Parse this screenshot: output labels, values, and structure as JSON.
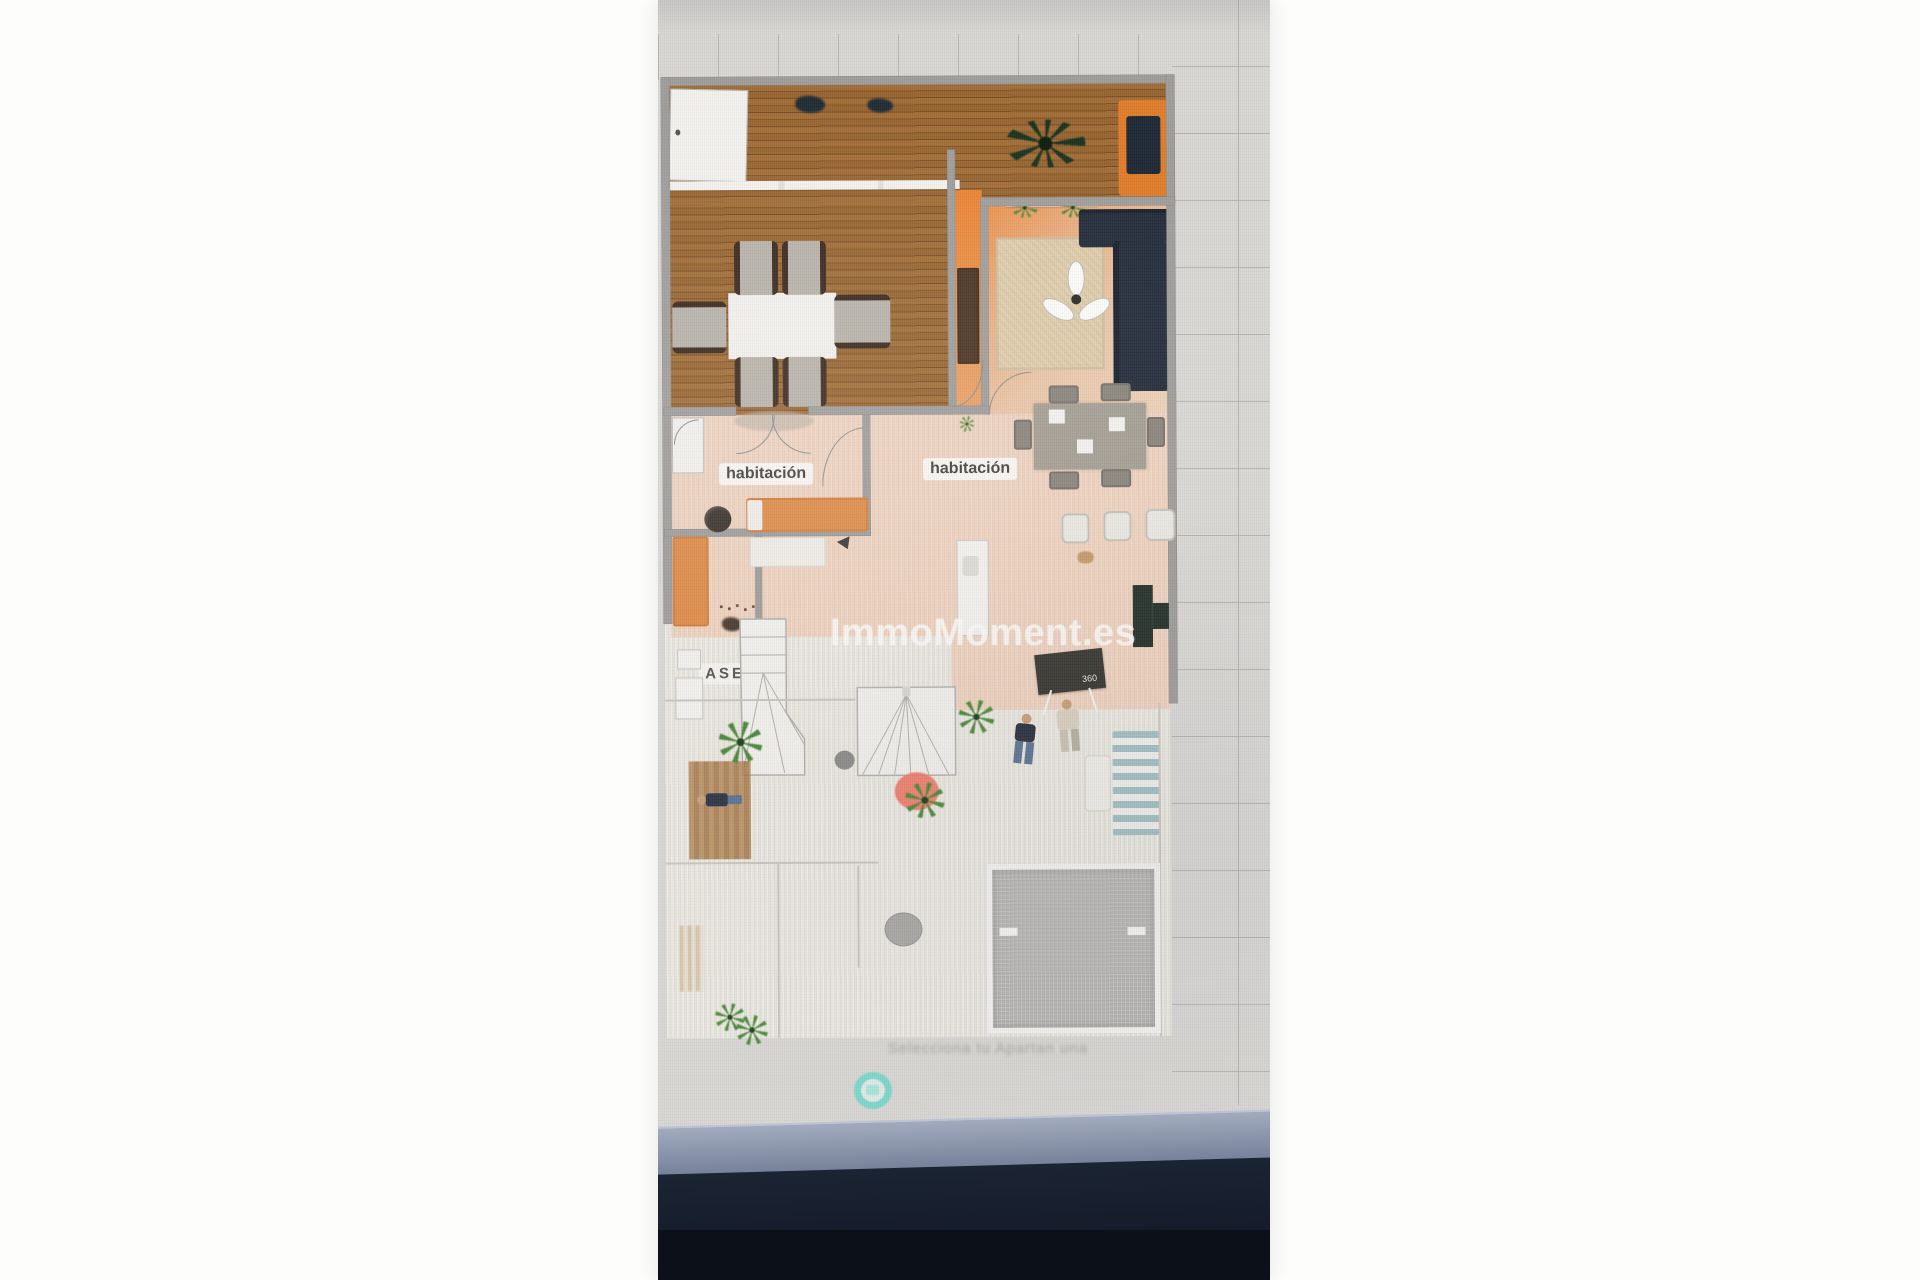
{
  "watermark": "ImmoMoment.es",
  "rooms": {
    "habitacion1": "habitación",
    "habitacion2": "habitación",
    "aseo": "ASEO"
  },
  "kitchen": {
    "board_sign": "360"
  },
  "footer": {
    "caption": "Selecciona tu Apartan una"
  },
  "palette": {
    "accent_teal": "#5BD2C0",
    "wood_floor": "#9A6733",
    "warm_floor": "#ECCFBB",
    "orange_accent": "#E5873B",
    "sofa_navy": "#222B39",
    "coral": "#EF7A69",
    "pool_gray": "#B4B3B0",
    "screen_gray": "#D8D7D4"
  }
}
